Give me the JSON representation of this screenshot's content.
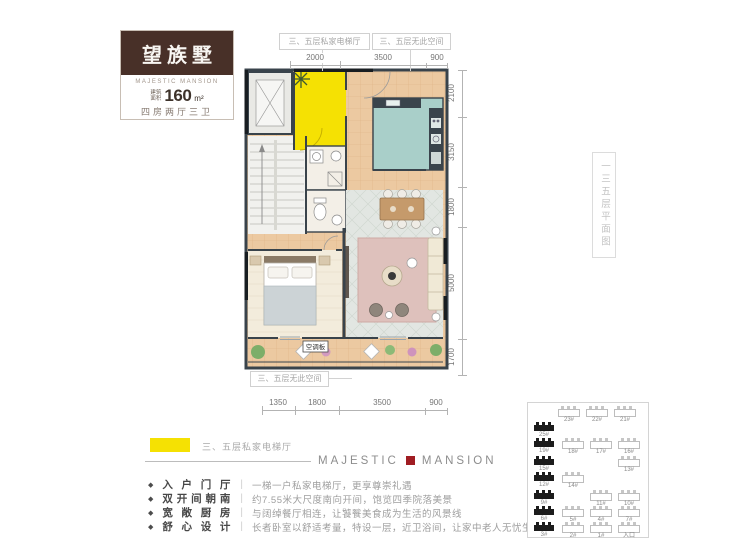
{
  "logo": {
    "name_cn": "望族墅",
    "name_en": "MAJESTIC MANSION",
    "area_prefix_1": "建筑",
    "area_prefix_2": "面积",
    "area_value": "160",
    "area_unit": "m²",
    "layout": "四房两厅三卫"
  },
  "plan": {
    "callouts": {
      "top_left": "三、五层私家电梯厅",
      "top_right": "三、五层无此空间",
      "bottom": "三、五层无此空间",
      "ac_label": "空调板"
    },
    "dimensions": {
      "top": [
        "2000",
        "3500",
        "900"
      ],
      "right": [
        "2100",
        "3150",
        "1800",
        "5000",
        "1700"
      ],
      "bottom": [
        "1350",
        "1800",
        "3500",
        "900"
      ]
    },
    "highlight_color": "#f5e103",
    "wall_color": "#39434b"
  },
  "side_label": "一三五层平面图",
  "legend": {
    "swatch_color": "#f5e103",
    "label": "三、五层私家电梯厅"
  },
  "brand": {
    "left": "MAJESTIC",
    "right": "MANSION",
    "square_color": "#a01d23"
  },
  "features": [
    {
      "title": "入户门厅",
      "desc": "一梯一户私家电梯厅，更享尊崇礼遇"
    },
    {
      "title": "双开间朝南",
      "desc": "约7.55米大尺度南向开间，饱览四季院落美景"
    },
    {
      "title": "宽敞厨房",
      "desc": "与阔绰餐厅相连，让饕餮美食成为生活的风景线"
    },
    {
      "title": "舒心设计",
      "desc": "长者卧室以舒适考量，特设一层，近卫浴间，让家中老人无忧生活起居"
    }
  ],
  "siteplan": {
    "highlight_color": "#1c1c1c",
    "buildings": [
      {
        "x": 30,
        "y": 6,
        "label": "23#",
        "filled": false
      },
      {
        "x": 58,
        "y": 6,
        "label": "22#",
        "filled": false
      },
      {
        "x": 86,
        "y": 6,
        "label": "21#",
        "filled": false
      },
      {
        "x": 6,
        "y": 22,
        "label": "25#",
        "filled": true
      },
      {
        "x": 6,
        "y": 38,
        "label": "19#",
        "filled": true
      },
      {
        "x": 6,
        "y": 56,
        "label": "15#",
        "filled": true
      },
      {
        "x": 6,
        "y": 72,
        "label": "12#",
        "filled": true
      },
      {
        "x": 6,
        "y": 90,
        "label": "9#",
        "filled": true
      },
      {
        "x": 6,
        "y": 106,
        "label": "6#",
        "filled": true
      },
      {
        "x": 6,
        "y": 122,
        "label": "3#",
        "filled": true
      },
      {
        "x": 34,
        "y": 38,
        "label": "18#",
        "filled": false
      },
      {
        "x": 34,
        "y": 72,
        "label": "14#",
        "filled": false
      },
      {
        "x": 34,
        "y": 106,
        "label": "5#",
        "filled": false
      },
      {
        "x": 34,
        "y": 122,
        "label": "2#",
        "filled": false
      },
      {
        "x": 62,
        "y": 38,
        "label": "17#",
        "filled": false
      },
      {
        "x": 62,
        "y": 90,
        "label": "11#",
        "filled": false
      },
      {
        "x": 62,
        "y": 106,
        "label": "4#",
        "filled": false
      },
      {
        "x": 62,
        "y": 122,
        "label": "1#",
        "filled": false
      },
      {
        "x": 90,
        "y": 38,
        "label": "16#",
        "filled": false
      },
      {
        "x": 90,
        "y": 56,
        "label": "13#",
        "filled": false
      },
      {
        "x": 90,
        "y": 90,
        "label": "10#",
        "filled": false
      },
      {
        "x": 90,
        "y": 106,
        "label": "7#",
        "filled": false
      },
      {
        "x": 90,
        "y": 122,
        "label": "入口",
        "filled": false
      }
    ]
  }
}
